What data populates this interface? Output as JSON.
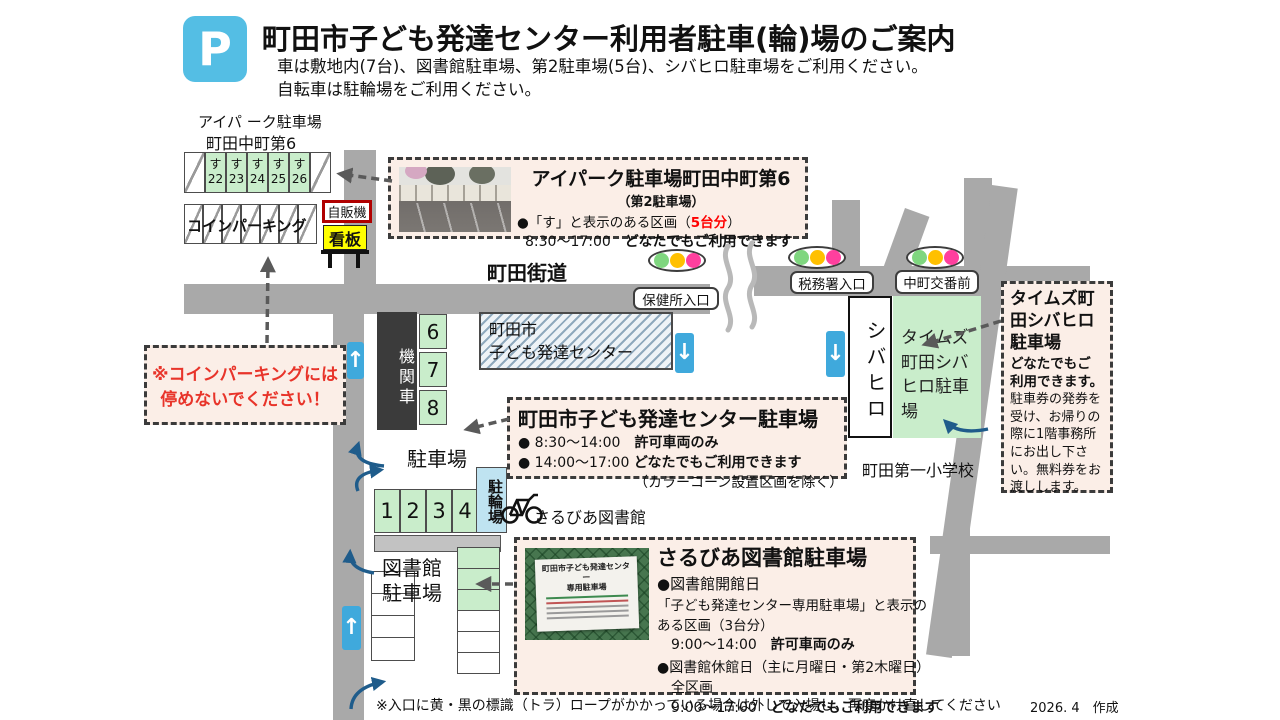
{
  "header": {
    "p_icon": "P",
    "title": "町田市子ども発達センター利用者駐車(輪)場のご案内",
    "subtitle1": "車は敷地内(7台)、図書館駐車場、第2駐車場(5台)、シバヒロ駐車場をご利用ください。",
    "subtitle2": "自転車は駐輪場をご利用ください。"
  },
  "map": {
    "aipark_label1": "アイパ ーク駐車場",
    "aipark_label2": "町田中町第6",
    "aipark_stalls": [
      {
        "kana": "す",
        "num": "22"
      },
      {
        "kana": "す",
        "num": "23"
      },
      {
        "kana": "す",
        "num": "24"
      },
      {
        "kana": "す",
        "num": "25"
      },
      {
        "kana": "す",
        "num": "26"
      }
    ],
    "coin_parking_label": "コインパーキング",
    "vending_label": "自販機",
    "signboard_label": "看板",
    "road_label": "町田街道",
    "bus_stop1": "保健所入口",
    "bus_stop2": "税務署入口",
    "bus_stop3": "中町交番前",
    "building_line1": "町田市",
    "building_line2": "子ども発達センター",
    "locomotive_label": "機関車",
    "site_stalls": [
      "6",
      "7",
      "8"
    ],
    "parking_label": "駐車場",
    "front_stalls": [
      "1",
      "2",
      "3",
      "4"
    ],
    "bicycle_area_label": "駐輪場",
    "library_name": "さるびあ図書館",
    "library_parking_line1": "図書館",
    "library_parking_line2": "駐車場",
    "shibahiro_label": "シバヒロ",
    "times_area_label": "タイムズ町田シバヒロ駐車場",
    "school_label": "町田第一小学校"
  },
  "callout_aipark": {
    "title": "アイパーク駐車場町田中町第6",
    "subtitle": "（第2駐車場）",
    "line1_plain": "●「す」と表示のある区画（",
    "line1_red": "5台分",
    "line1_close": "）",
    "line2_time": "8:30～17:00",
    "line2_bold": "どなたでもご利用できます"
  },
  "callout_center": {
    "title": "町田市子ども発達センター駐車場",
    "line1_plain": "● 8:30～14:00　",
    "line1_bold": "許可車両のみ",
    "line2_plain": "● 14:00～17:00 ",
    "line2_bold": "どなたでもご利用できます",
    "line3": "（カラーコーン設置区画を除く）"
  },
  "callout_times": {
    "title": "タイムズ町田シバヒロ駐車場",
    "emphasis": "どなたでもご利用できます。",
    "body": "駐車券の発券を受け、お帰りの際に1階事務所にお出し下さい。無料券をお渡しします。"
  },
  "callout_warning": {
    "line1": "※コインパーキングには",
    "line2": "停めないでください！"
  },
  "callout_sarubia": {
    "title": "さるびあ図書館駐車場",
    "photo_sign_line1": "町田市子ども発達センター",
    "photo_sign_line2": "専用駐車場",
    "open_head": "●図書館開館日",
    "open_line1": "「子ども発達センター専用駐車場」と表示の",
    "open_line2": "ある区画（3台分）",
    "open_time": "9:00～14:00　",
    "open_bold": "許可車両のみ",
    "closed_head": "●図書館休館日（主に月曜日・第2木曜日）",
    "closed_line1": "全区画",
    "closed_time": "9:00～17:00　",
    "closed_bold": "どなたでもご利用できます"
  },
  "footer": {
    "note": "※入口に黄・黒の標識（トラ）ロープがかかっている場合は外して入場し、再度かけ直してください",
    "credit": "2026. 4　作成"
  },
  "colors": {
    "p_icon_blue": "#54BEE4",
    "road_gray": "#A9A9A9",
    "stall_green": "#C9EDCB",
    "bike_area_blue": "#BFE3F1",
    "callout_bg": "#FBEEE7",
    "warning_text_red": "#E8342A",
    "highlight_red": "#FF0000",
    "nav_arrow_blue": "#3FA9DC",
    "guide_arrow_navy": "#1F5C8B",
    "signboard_yellow": "#FFFF00",
    "vending_border_red": "#B00000",
    "traffic_green": "#7FD67F",
    "traffic_yellow": "#FFC000",
    "traffic_pink": "#FF3F9E"
  }
}
